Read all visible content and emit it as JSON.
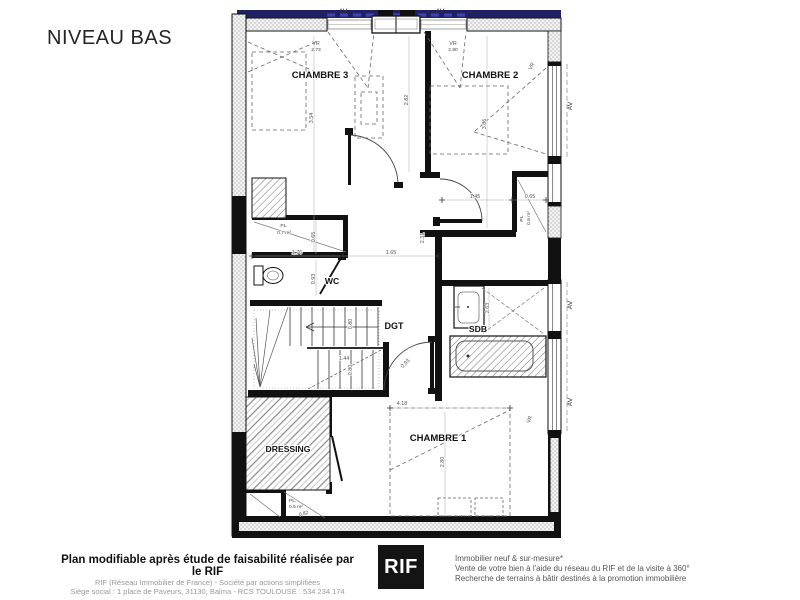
{
  "title": "NIVEAU BAS",
  "plan": {
    "rooms": {
      "chambre3": "CHAMBRE 3",
      "chambre2": "CHAMBRE 2",
      "chambre1": "CHAMBRE 1",
      "wc": "WC",
      "dgt": "DGT",
      "sdb": "SDB",
      "dressing": "DRESSING"
    },
    "windows": {
      "av_top_left": "AV",
      "av_top_right": "AV",
      "av_right_top": "AV",
      "av_right_mid": "AV",
      "av_right_bottom": "AV",
      "vr_top_left": "VR",
      "vr_top_left_value": "2.73",
      "vr_top_right": "VR",
      "vr_top_right_value": "2.80",
      "vr_right_chambre2": "VR",
      "vr_right_chambre1": "VR"
    },
    "dimensions": {
      "chambre3_depth": "3.54",
      "hall_top": "2.82",
      "chambre2_depth": "3.86",
      "vestibule_width": "1.45",
      "closet_ch2_width": "0.65",
      "closet_wc_depth": "0.65",
      "wc_width": "1.76",
      "wc_depth": "0.93",
      "hall_width": "1.65",
      "hall_depth": "2.31",
      "sdb_depth": "2.63",
      "stair_width": "1.44",
      "stair_run_top": "0.80",
      "stair_run_bottom": "0.80",
      "chambre1_door": "0.93",
      "chambre1_width": "4.18",
      "chambre1_depth": "2.80",
      "closet_dressing_width": "0.82"
    },
    "closets": {
      "pl_wc_label": "PL.",
      "pl_wc_area": "0.7 m²",
      "pl_ch2_label": "PL.",
      "pl_ch2_area": "0.8 m²",
      "pl_dressing_label": "PL.",
      "pl_dressing_area": "0.5 m²"
    }
  },
  "footer": {
    "disclaimer_bold": "Plan modifiable après étude de faisabilité réalisée par le RIF",
    "company_line1": "RIF (Réseau Immobilier de France) - Société par actions simplifiées",
    "company_line2": "Siège social : 1 place de Paveurs, 31130, Balma - RCS TOULOUSE : 534 234 174",
    "logo_text": "RIF",
    "services_line1": "Immobilier neuf & sur-mesure*",
    "services_line2": "Vente de votre bien à l'aide du réseau du RIF et de la visite à 360°",
    "services_line3": "Recherche de terrains à bâtir destinés à la promotion immobilière"
  }
}
